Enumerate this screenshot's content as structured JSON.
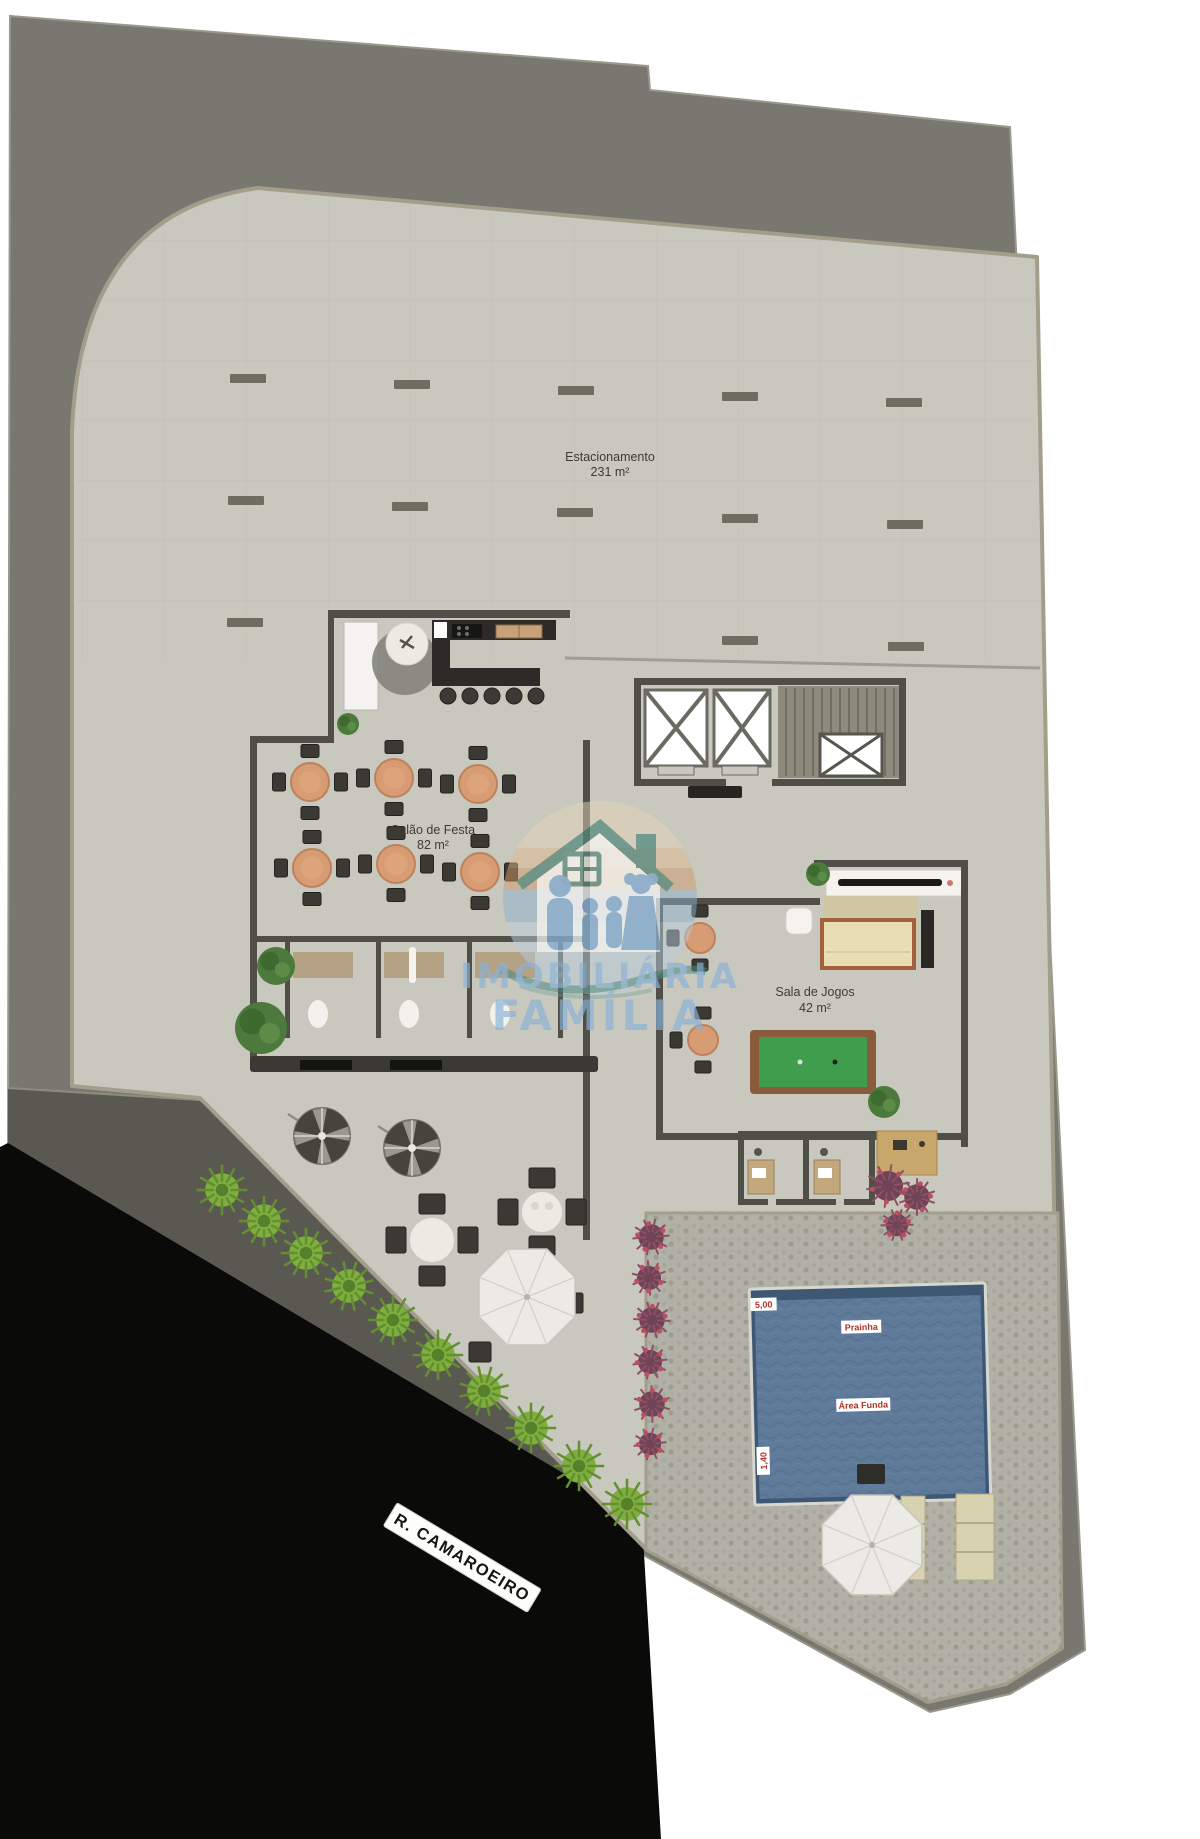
{
  "rooms": {
    "parking": {
      "name": "Estacionamento",
      "area": "231 m²"
    },
    "party_hall": {
      "name": "Salão de Festa",
      "area": "82 m²"
    },
    "game_room": {
      "name": "Sala de Jogos",
      "area": "42 m²"
    }
  },
  "pool": {
    "length_label": "5,00",
    "shallow_label": "Prainha",
    "deep_label": "Área Funda",
    "depth_label": "1,40"
  },
  "street": {
    "name": "R. CAMAROEIRO"
  },
  "watermark": {
    "line1": "IMOBILIÁRIA",
    "line2": "FAMÍLIA"
  },
  "palette": {
    "lot_gray": "#787770",
    "slab_gray": "#c9c8bf",
    "deck_gray": "#b2b1a7",
    "street_black": "#0a0a09",
    "sidewalk_gray": "#5a5951",
    "wall_dark": "#4f4e47",
    "pool_blue": "#5f7b99",
    "pool_rim_blue": "#3e5874",
    "pool_label_red": "#b03229",
    "table_salmon": "#d79c74",
    "chair_dark": "#3a3933",
    "lawn_green": "#7fae3f",
    "tree_green": "#4c7a3c",
    "purple_plant": "#6e4456",
    "billiards_green": "#3f9e4e",
    "wood_tan": "#c7a76b",
    "umbrella_white": "#ebeae4",
    "watermark_blue": "#8ab3d6",
    "watermark_teal": "#3f7d72",
    "watermark_orange": "#cf9a68"
  }
}
